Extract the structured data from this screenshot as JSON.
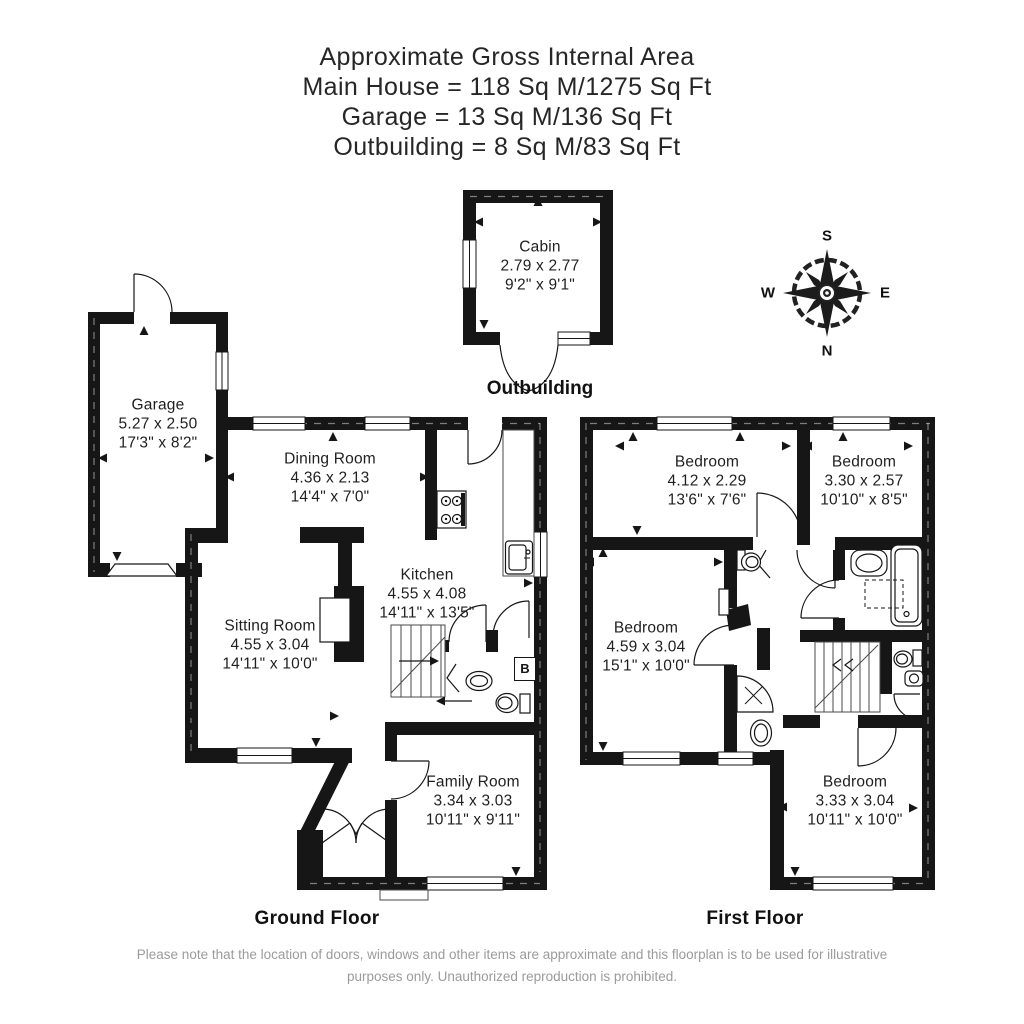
{
  "title": {
    "line1": "Approximate Gross Internal Area",
    "line2": "Main House = 118 Sq M/1275 Sq Ft",
    "line3": "Garage = 13 Sq M/136 Sq Ft",
    "line4": "Outbuilding = 8 Sq M/83 Sq Ft"
  },
  "labels": {
    "ground_floor": "Ground Floor",
    "first_floor": "First Floor",
    "outbuilding": "Outbuilding",
    "boiler": "B"
  },
  "compass": {
    "n": "N",
    "s": "S",
    "e": "E",
    "w": "W"
  },
  "rooms": {
    "garage": {
      "name": "Garage",
      "metric": "5.27 x 2.50",
      "imperial": "17'3\" x 8'2\""
    },
    "dining": {
      "name": "Dining Room",
      "metric": "4.36 x 2.13",
      "imperial": "14'4\" x 7'0\""
    },
    "kitchen": {
      "name": "Kitchen",
      "metric": "4.55 x 4.08",
      "imperial": "14'11\" x 13'5\""
    },
    "sitting": {
      "name": "Sitting Room",
      "metric": "4.55 x 3.04",
      "imperial": "14'11\" x 10'0\""
    },
    "family": {
      "name": "Family Room",
      "metric": "3.34 x 3.03",
      "imperial": "10'11\" x 9'11\""
    },
    "cabin": {
      "name": "Cabin",
      "metric": "2.79 x 2.77",
      "imperial": "9'2\" x 9'1\""
    },
    "bed1": {
      "name": "Bedroom",
      "metric": "4.12 x 2.29",
      "imperial": "13'6\" x 7'6\""
    },
    "bed2": {
      "name": "Bedroom",
      "metric": "3.30 x 2.57",
      "imperial": "10'10\" x 8'5\""
    },
    "bed3": {
      "name": "Bedroom",
      "metric": "4.59 x 3.04",
      "imperial": "15'1\" x 10'0\""
    },
    "bed4": {
      "name": "Bedroom",
      "metric": "3.33 x 3.04",
      "imperial": "10'11\" x 10'0\""
    }
  },
  "footer": {
    "line1": "Please note that the location of doors, windows and other items are approximate and this floorplan is to be used for illustrative",
    "line2": "purposes only. Unauthorized reproduction is prohibited."
  },
  "colors": {
    "wall": "#161616",
    "text": "#262626",
    "footer_text": "#9b9b9b"
  }
}
